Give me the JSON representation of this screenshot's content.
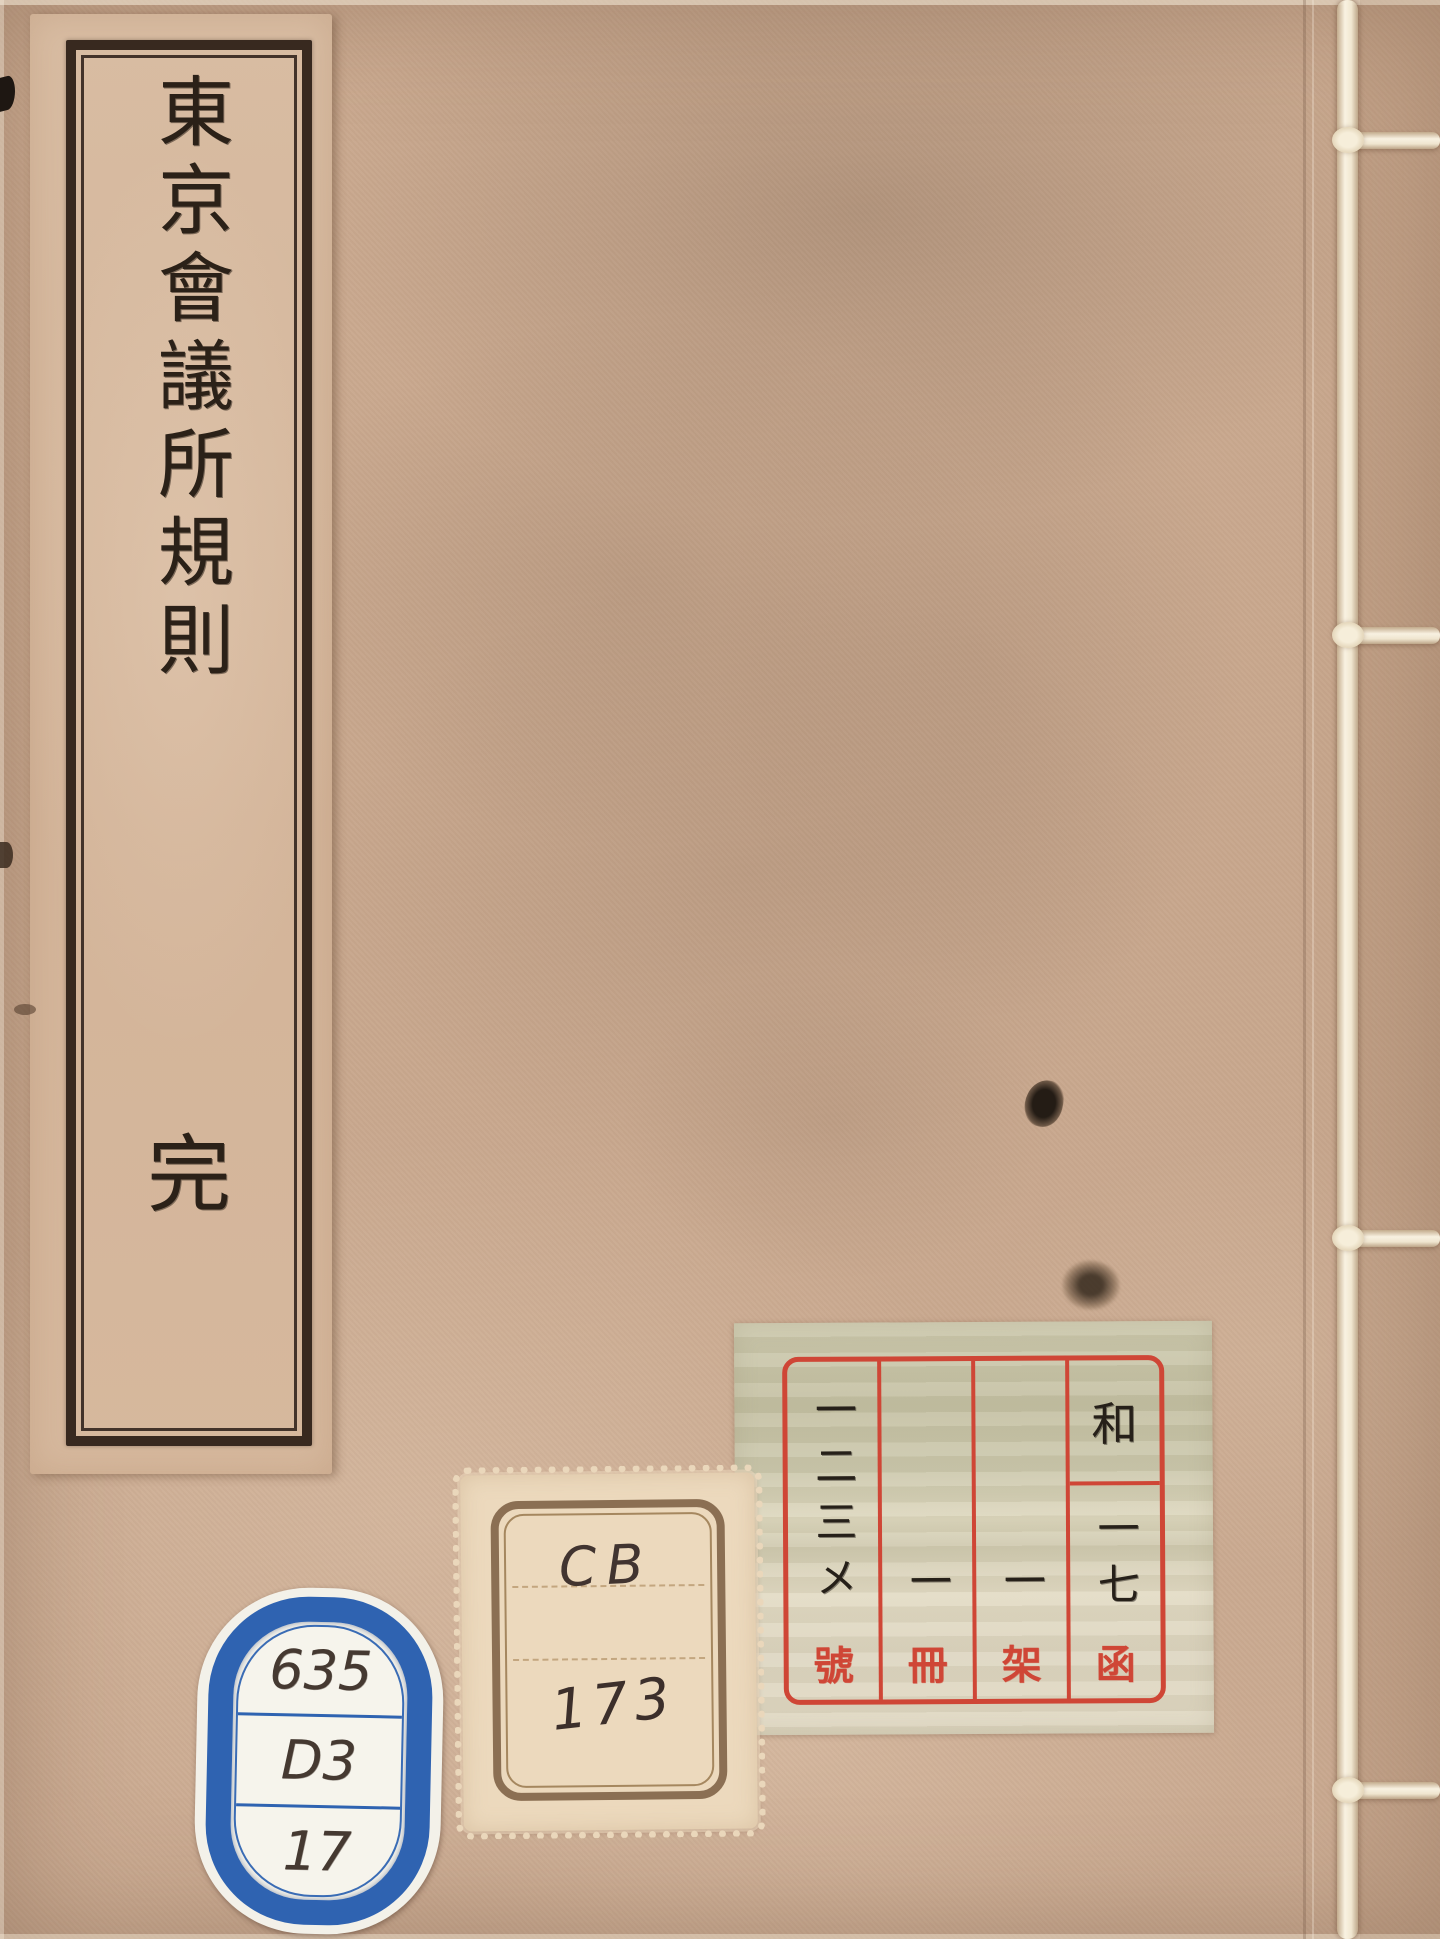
{
  "page": {
    "description": "Scanned front cover of a traditional Japanese stab-bound (yotsume-toji) book with aged paper, title slip, library labels and binding thread",
    "title_slip": {
      "title_vertical": "東京會議所規則",
      "end_mark": "完"
    },
    "accession_label": {
      "columns": [
        {
          "number": "一二三メ",
          "unit": "號"
        },
        {
          "number": "一",
          "unit": "冊"
        },
        {
          "number": "一",
          "unit": "架"
        },
        {
          "top": "和",
          "number": "一七",
          "unit": "函"
        }
      ]
    },
    "cb_stamp": {
      "code": "CB",
      "number": "173"
    },
    "call_number_label": {
      "rows": [
        "635",
        "D3",
        "17"
      ]
    },
    "colors": {
      "cover_paper": "#c8a78d",
      "slip_paper": "#d5b89d",
      "ink": "#2b2118",
      "label_red": "#cf4636",
      "accession_paper": "#cdc9ad",
      "stamp_paper": "#ecd9bd",
      "stamp_border": "#8b6f53",
      "call_label_blue": "#2f63b1",
      "binding_thread": "#f6efdf"
    }
  }
}
